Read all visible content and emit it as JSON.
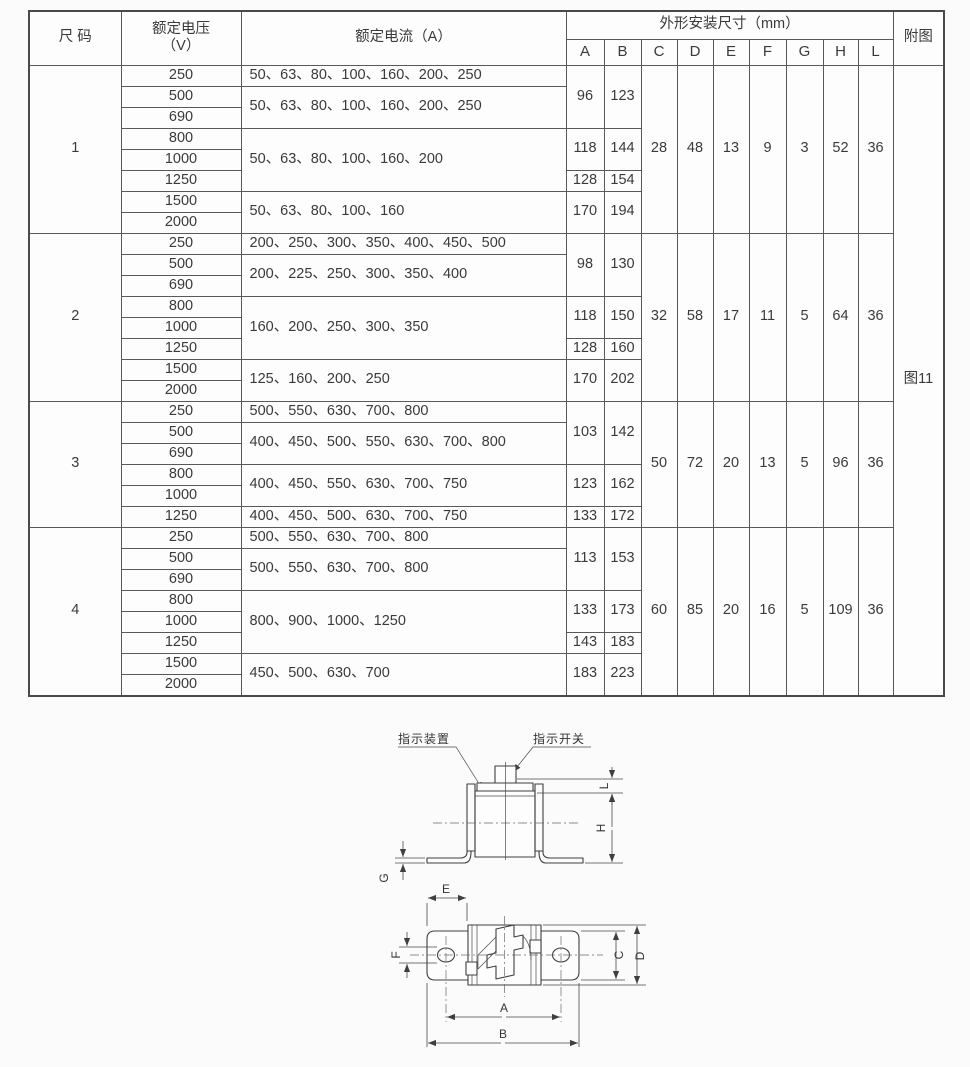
{
  "table": {
    "header": {
      "size": "尺 码",
      "voltage_l1": "额定电压",
      "voltage_l2": "（V）",
      "current": "额定电流（A）",
      "dims": "外形安装尺寸（mm）",
      "dim_cols": [
        "A",
        "B",
        "C",
        "D",
        "E",
        "F",
        "G",
        "H",
        "L"
      ],
      "figure": "附图"
    },
    "figure_ref": "图11",
    "groups": [
      {
        "size": "1",
        "voltages": [
          "250",
          "500",
          "690",
          "800",
          "1000",
          "1250",
          "1500",
          "2000"
        ],
        "currents": [
          {
            "span": 1,
            "text": "50、63、80、100、160、200、250"
          },
          {
            "span": 2,
            "text": "50、63、80、100、160、200、250"
          },
          {
            "span": 3,
            "text": "50、63、80、100、160、200"
          },
          {
            "span": 2,
            "text": "50、63、80、100、160"
          }
        ],
        "ab": [
          {
            "span": 3,
            "a": "96",
            "b": "123"
          },
          {
            "span": 2,
            "a": "118",
            "b": "144"
          },
          {
            "span": 1,
            "a": "128",
            "b": "154"
          },
          {
            "span": 2,
            "a": "170",
            "b": "194"
          }
        ],
        "cdefghl": [
          "28",
          "48",
          "13",
          "9",
          "3",
          "52",
          "36"
        ]
      },
      {
        "size": "2",
        "voltages": [
          "250",
          "500",
          "690",
          "800",
          "1000",
          "1250",
          "1500",
          "2000"
        ],
        "currents": [
          {
            "span": 1,
            "text": "200、250、300、350、400、450、500"
          },
          {
            "span": 2,
            "text": "200、225、250、300、350、400"
          },
          {
            "span": 3,
            "text": "160、200、250、300、350"
          },
          {
            "span": 2,
            "text": "125、160、200、250"
          }
        ],
        "ab": [
          {
            "span": 3,
            "a": "98",
            "b": "130"
          },
          {
            "span": 2,
            "a": "118",
            "b": "150"
          },
          {
            "span": 1,
            "a": "128",
            "b": "160"
          },
          {
            "span": 2,
            "a": "170",
            "b": "202"
          }
        ],
        "cdefghl": [
          "32",
          "58",
          "17",
          "11",
          "5",
          "64",
          "36"
        ]
      },
      {
        "size": "3",
        "voltages": [
          "250",
          "500",
          "690",
          "800",
          "1000",
          "1250"
        ],
        "currents": [
          {
            "span": 1,
            "text": "500、550、630、700、800"
          },
          {
            "span": 2,
            "text": "400、450、500、550、630、700、800"
          },
          {
            "span": 2,
            "text": "400、450、550、630、700、750"
          },
          {
            "span": 1,
            "text": "400、450、500、630、700、750"
          }
        ],
        "ab": [
          {
            "span": 3,
            "a": "103",
            "b": "142"
          },
          {
            "span": 2,
            "a": "123",
            "b": "162"
          },
          {
            "span": 1,
            "a": "133",
            "b": "172"
          }
        ],
        "cdefghl": [
          "50",
          "72",
          "20",
          "13",
          "5",
          "96",
          "36"
        ]
      },
      {
        "size": "4",
        "voltages": [
          "250",
          "500",
          "690",
          "800",
          "1000",
          "1250",
          "1500",
          "2000"
        ],
        "currents": [
          {
            "span": 1,
            "text": "500、550、630、700、800"
          },
          {
            "span": 2,
            "text": "500、550、630、700、800"
          },
          {
            "span": 3,
            "text": "800、900、1000、1250"
          },
          {
            "span": 2,
            "text": "450、500、630、700"
          }
        ],
        "ab": [
          {
            "span": 3,
            "a": "113",
            "b": "153"
          },
          {
            "span": 2,
            "a": "133",
            "b": "173"
          },
          {
            "span": 1,
            "a": "143",
            "b": "183"
          },
          {
            "span": 2,
            "a": "183",
            "b": "223"
          }
        ],
        "cdefghl": [
          "60",
          "85",
          "20",
          "16",
          "5",
          "109",
          "36"
        ]
      }
    ]
  },
  "diagram": {
    "callout_device": "指示装置",
    "callout_switch": "指示开关",
    "dims": {
      "L": "L",
      "H": "H",
      "G": "G",
      "E": "E",
      "F": "F",
      "C": "C",
      "D": "D",
      "A": "A",
      "B": "B"
    }
  }
}
